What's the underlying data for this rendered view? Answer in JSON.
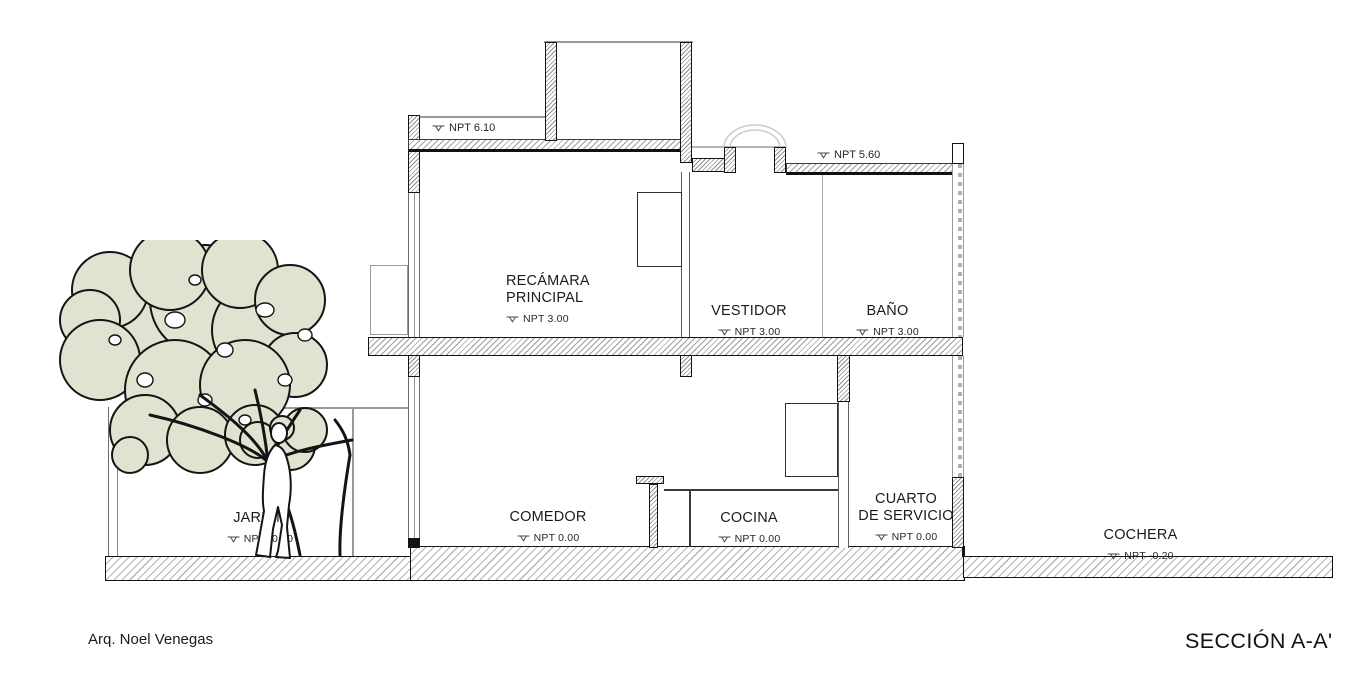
{
  "title_block": {
    "architect": "Arq. Noel Venegas",
    "section": "SECCIÓN A-A'"
  },
  "levels": {
    "roof_upper": "NPT 6.10",
    "roof_lower": "NPT 5.60"
  },
  "rooms": {
    "recamara_principal": {
      "line1": "RECÁMARA",
      "line2": "PRINCIPAL",
      "npt": "NPT 3.00"
    },
    "vestidor": {
      "name": "VESTIDOR",
      "npt": "NPT 3.00"
    },
    "bano": {
      "name": "BAÑO",
      "npt": "NPT 3.00"
    },
    "comedor": {
      "name": "COMEDOR",
      "npt": "NPT 0.00"
    },
    "cocina": {
      "name": "COCINA",
      "npt": "NPT 0.00"
    },
    "cuarto_servicio": {
      "line1": "CUARTO",
      "line2": "DE SERVICIO",
      "npt": "NPT 0.00"
    },
    "cochera": {
      "name": "COCHERA",
      "npt": "NPT -0.20"
    },
    "jardin": {
      "name": "JARDÍN",
      "npt": "NPT -0.20"
    }
  },
  "colors": {
    "foliage": "#dfe4d0",
    "cut_line": "#141414",
    "hatch_line": "#9a9a9a",
    "light_line": "#cccccc"
  }
}
